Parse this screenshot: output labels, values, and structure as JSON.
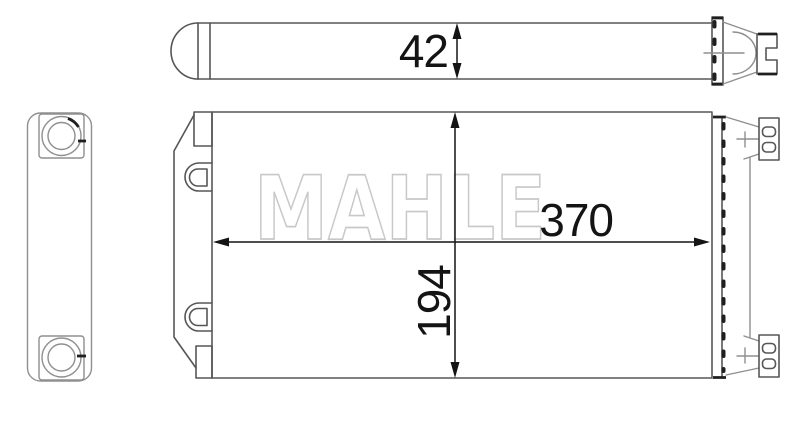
{
  "watermark": {
    "text": "MAHLE"
  },
  "dimensions": {
    "depth": "42",
    "width": "370",
    "height": "194"
  },
  "colors": {
    "background": "#ffffff",
    "line": "#565656",
    "line-light": "#8f8f8f",
    "line-dark": "#1f1f1f",
    "dim": "#141414",
    "watermark": "#c8c8c8"
  }
}
